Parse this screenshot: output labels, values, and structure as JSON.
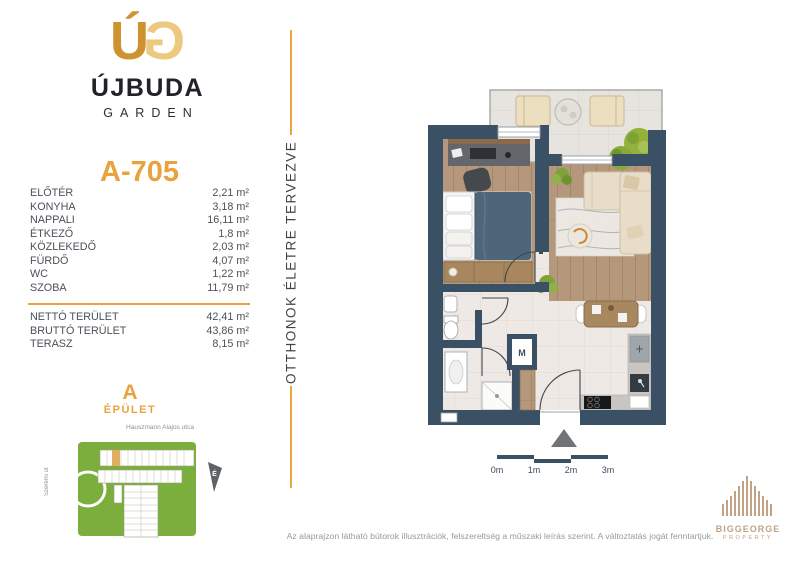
{
  "brand": {
    "monogram_u": "Ú",
    "monogram_g": "G",
    "name": "ÚJBUDA",
    "sub": "GARDEN"
  },
  "unit": {
    "id": "A-705"
  },
  "rooms": [
    {
      "label": "ELŐTÉR",
      "area": "2,21 m²"
    },
    {
      "label": "KONYHA",
      "area": "3,18 m²"
    },
    {
      "label": "NAPPALI",
      "area": "16,11 m²"
    },
    {
      "label": "ÉTKEZŐ",
      "area": "1,8 m²"
    },
    {
      "label": "KÖZLEKEDŐ",
      "area": "2,03 m²"
    },
    {
      "label": "FÜRDŐ",
      "area": "4,07 m²"
    },
    {
      "label": "WC",
      "area": "1,22 m²"
    },
    {
      "label": "SZOBA",
      "area": "11,79 m²"
    }
  ],
  "totals": [
    {
      "label": "NETTÓ TERÜLET",
      "area": "42,41 m²"
    },
    {
      "label": "BRUTTÓ TERÜLET",
      "area": "43,86 m²"
    },
    {
      "label": "TERASZ",
      "area": "8,15 m²"
    }
  ],
  "building": {
    "letter": "A",
    "label": "ÉPÜLET"
  },
  "map": {
    "street_top": "Hauszmann Alajos utca",
    "street_left": "Szerémi út",
    "compass": "É"
  },
  "tagline": "OTTHONOK ÉLETRE TERVEZVE",
  "plan": {
    "m_label": "M",
    "scale_labels": [
      "0m",
      "1m",
      "2m",
      "3m"
    ]
  },
  "footer": {
    "disclaimer": "Az alaprajzon látható bútorok illusztrációk, felszereltség a műszaki leírás szerint. A változtatás jogát fenntartjuk."
  },
  "biggeorge": {
    "name": "BIGGEORGE",
    "sub": "PROPERTY"
  },
  "colors": {
    "gold": "#E8A33C",
    "wall_navy": "#3A5065",
    "map_green": "#7CAE3E",
    "logo_tan": "#C2A284"
  }
}
